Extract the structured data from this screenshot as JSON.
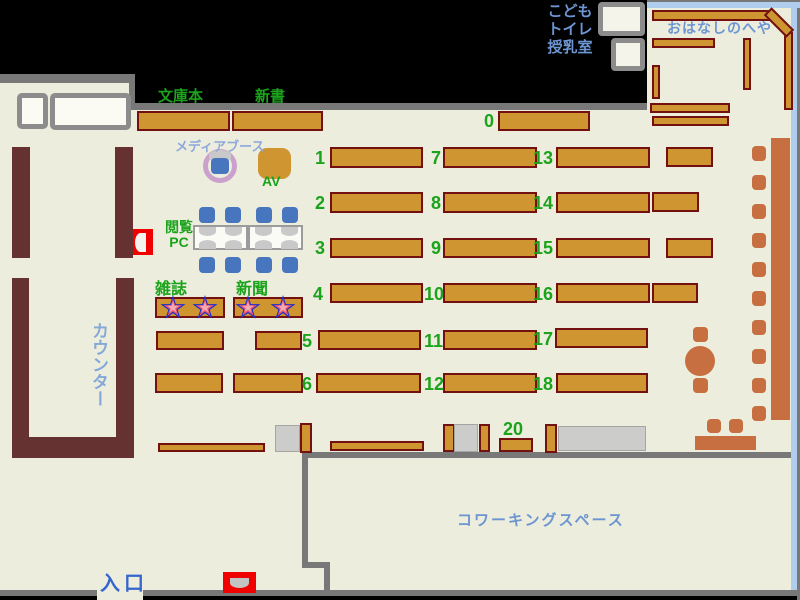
{
  "title": "library-floor-map",
  "colors": {
    "floor": "#ECEDDD",
    "wall": "#787878",
    "shelf_fill": "#CE9530",
    "shelf_border": "#731010",
    "counter": "#653231",
    "sienna": "#C76F41",
    "chair_blue": "#4876BE",
    "green": "#1CA31C",
    "label_blue": "#6C95D2",
    "counter_blue": "#84A8D8",
    "entrance_blue": "#3566CE",
    "media_blue": "#8FA8DC",
    "window_blue": "#AFCDED",
    "plum": "#CBA0CD",
    "red": "#F10000",
    "star_blue": "#1E2ECC",
    "star_red": "#E8566A",
    "star_pink": "#F6A9B2",
    "pillar": "#CCCCCB",
    "table_white": "#FBFBF6",
    "dome_gray": "#C9C9C9"
  },
  "labels": [
    {
      "id": "bunkobon",
      "text": "文庫本",
      "x": 158,
      "y": 85,
      "size": 15,
      "color": "green"
    },
    {
      "id": "shinsho",
      "text": "新書",
      "x": 255,
      "y": 85,
      "size": 15,
      "color": "green"
    },
    {
      "id": "media-booth",
      "text": "メディアブース",
      "x": 175,
      "y": 136,
      "size": 13,
      "color": "media_blue"
    },
    {
      "id": "av",
      "text": "AV",
      "x": 262,
      "y": 173,
      "size": 14,
      "color": "green"
    },
    {
      "id": "reading-pc",
      "text": "閲覧\nPC",
      "x": 160,
      "y": 220,
      "size": 14,
      "color": "green",
      "align": "center",
      "w": 38,
      "lh": 15
    },
    {
      "id": "zasshi",
      "text": "雑誌",
      "x": 155,
      "y": 275,
      "size": 16,
      "color": "green"
    },
    {
      "id": "shinbun",
      "text": "新聞",
      "x": 236,
      "y": 275,
      "size": 16,
      "color": "green"
    },
    {
      "id": "counter",
      "text": "カウンター",
      "x": 86,
      "y": 322,
      "size": 17,
      "color": "counter_blue",
      "vertical": true
    },
    {
      "id": "kids-toilet-nursing",
      "text": "こども\nトイレ\n授乳室",
      "x": 540,
      "y": 3,
      "size": 15,
      "color": "label_blue",
      "align": "center",
      "w": 60,
      "lh": 18
    },
    {
      "id": "ohanashi-room",
      "text": "おはなしのへや",
      "x": 667,
      "y": 18,
      "size": 14,
      "color": "label_blue",
      "ls": 1
    },
    {
      "id": "coworking",
      "text": "コワーキングスペース",
      "x": 457,
      "y": 509,
      "size": 15,
      "color": "label_blue",
      "ls": 2
    },
    {
      "id": "entrance",
      "text": "入口",
      "x": 100,
      "y": 567,
      "size": 20,
      "color": "entrance_blue",
      "ls": 4
    }
  ],
  "shelf_numbers": [
    {
      "text": "0",
      "x": 484,
      "y": 111
    },
    {
      "text": "1",
      "x": 315,
      "y": 148
    },
    {
      "text": "2",
      "x": 315,
      "y": 193
    },
    {
      "text": "3",
      "x": 315,
      "y": 238
    },
    {
      "text": "4",
      "x": 313,
      "y": 284
    },
    {
      "text": "5",
      "x": 302,
      "y": 331
    },
    {
      "text": "6",
      "x": 302,
      "y": 374
    },
    {
      "text": "7",
      "x": 431,
      "y": 148
    },
    {
      "text": "8",
      "x": 431,
      "y": 193
    },
    {
      "text": "9",
      "x": 431,
      "y": 238
    },
    {
      "text": "10",
      "x": 424,
      "y": 284
    },
    {
      "text": "11",
      "x": 424,
      "y": 331
    },
    {
      "text": "12",
      "x": 424,
      "y": 374
    },
    {
      "text": "13",
      "x": 533,
      "y": 148
    },
    {
      "text": "14",
      "x": 533,
      "y": 193
    },
    {
      "text": "15",
      "x": 533,
      "y": 238
    },
    {
      "text": "16",
      "x": 533,
      "y": 284
    },
    {
      "text": "17",
      "x": 533,
      "y": 329
    },
    {
      "text": "18",
      "x": 533,
      "y": 374
    },
    {
      "text": "20",
      "x": 503,
      "y": 419
    }
  ],
  "floors": [
    [
      0,
      83,
      797,
      507
    ],
    [
      647,
      2,
      144,
      81
    ],
    [
      97,
      590,
      46,
      10
    ]
  ],
  "black_patches": [
    [
      135,
      0,
      512,
      103
    ]
  ],
  "walls": [
    [
      0,
      74,
      135,
      9
    ],
    [
      129,
      74,
      6,
      36
    ],
    [
      135,
      103,
      512,
      7
    ],
    [
      303,
      452,
      497,
      6
    ],
    [
      302,
      452,
      6,
      116
    ],
    [
      302,
      562,
      28,
      6
    ],
    [
      324,
      562,
      6,
      34
    ],
    [
      0,
      590,
      97,
      6
    ],
    [
      143,
      590,
      657,
      6
    ],
    [
      647,
      0,
      153,
      2
    ],
    [
      797,
      0,
      3,
      600
    ]
  ],
  "windows": [
    [
      647,
      2,
      153,
      6
    ],
    [
      791,
      3,
      6,
      587
    ]
  ],
  "toilet_rooms": [
    [
      598,
      2,
      47,
      34
    ],
    [
      611,
      38,
      34,
      33
    ]
  ],
  "desk_boxes": [
    [
      17,
      93,
      31,
      36
    ],
    [
      50,
      93,
      81,
      37
    ]
  ],
  "counter_blocks": [
    [
      12,
      147,
      18,
      111
    ],
    [
      115,
      147,
      18,
      111
    ],
    [
      12,
      278,
      17,
      180
    ],
    [
      116,
      278,
      18,
      180
    ],
    [
      12,
      437,
      121,
      21
    ]
  ],
  "shelves_h": [
    [
      137,
      111,
      93,
      20
    ],
    [
      232,
      111,
      91,
      20
    ],
    [
      498,
      111,
      92,
      20
    ],
    [
      330,
      147,
      93,
      21
    ],
    [
      330,
      192,
      93,
      21
    ],
    [
      330,
      238,
      93,
      20
    ],
    [
      330,
      283,
      93,
      20
    ],
    [
      318,
      330,
      103,
      20
    ],
    [
      316,
      373,
      105,
      20
    ],
    [
      443,
      147,
      94,
      21
    ],
    [
      443,
      192,
      94,
      21
    ],
    [
      443,
      238,
      94,
      20
    ],
    [
      443,
      283,
      94,
      20
    ],
    [
      443,
      330,
      94,
      20
    ],
    [
      443,
      373,
      94,
      20
    ],
    [
      556,
      147,
      94,
      21
    ],
    [
      556,
      192,
      94,
      21
    ],
    [
      556,
      238,
      94,
      20
    ],
    [
      556,
      283,
      94,
      20
    ],
    [
      555,
      328,
      93,
      20
    ],
    [
      556,
      373,
      92,
      20
    ],
    [
      666,
      147,
      47,
      20
    ],
    [
      652,
      192,
      47,
      20
    ],
    [
      666,
      238,
      47,
      20
    ],
    [
      652,
      283,
      46,
      20
    ],
    [
      155,
      297,
      70,
      21
    ],
    [
      233,
      297,
      70,
      21
    ],
    [
      156,
      331,
      68,
      19
    ],
    [
      255,
      331,
      47,
      19
    ],
    [
      155,
      373,
      68,
      20
    ],
    [
      233,
      373,
      70,
      20
    ],
    [
      652,
      10,
      118,
      11
    ],
    [
      652,
      38,
      63,
      10
    ],
    [
      650,
      103,
      80,
      10
    ],
    [
      652,
      116,
      77,
      10
    ],
    [
      499,
      438,
      34,
      14
    ],
    [
      158,
      443,
      107,
      9
    ],
    [
      330,
      441,
      94,
      10
    ]
  ],
  "shelves_v": [
    [
      652,
      65,
      8,
      34
    ],
    [
      743,
      38,
      8,
      52
    ],
    [
      784,
      32,
      9,
      78
    ],
    [
      300,
      423,
      12,
      30
    ],
    [
      443,
      424,
      12,
      28
    ],
    [
      479,
      424,
      11,
      28
    ],
    [
      545,
      424,
      12,
      29
    ]
  ],
  "rotated_shelf": {
    "x": 763,
    "y": 17,
    "w": 32,
    "h": 11,
    "angle": 45
  },
  "pillars": [
    [
      275,
      425,
      25,
      27
    ],
    [
      454,
      424,
      24,
      28
    ]
  ],
  "gray_table": [
    558,
    426,
    88,
    25
  ],
  "sienna": {
    "wall_seats_x": 752,
    "wall_seats_y": [
      146,
      175,
      204,
      233,
      262,
      291,
      320,
      349,
      378,
      406
    ],
    "wall_seat_w": 14,
    "wall_seat_h": 15,
    "bench_strip": [
      771,
      138,
      19,
      282
    ],
    "round_table": [
      685,
      346,
      30,
      30
    ],
    "table_seats": [
      [
        693,
        327,
        15,
        15
      ],
      [
        693,
        378,
        15,
        15
      ]
    ],
    "bottom_bench": [
      695,
      436,
      61,
      14
    ],
    "bottom_seats": [
      [
        707,
        419,
        14,
        14
      ],
      [
        729,
        419,
        14,
        14
      ]
    ]
  },
  "pc_area": {
    "tables": [
      [
        193,
        225,
        55,
        25
      ],
      [
        248,
        225,
        55,
        25
      ]
    ],
    "domes_down": [
      [
        199,
        227
      ],
      [
        225,
        227
      ],
      [
        255,
        227
      ],
      [
        281,
        227
      ]
    ],
    "domes_up": [
      [
        199,
        240
      ],
      [
        225,
        240
      ],
      [
        255,
        240
      ],
      [
        281,
        240
      ]
    ],
    "dome_w": 17,
    "dome_h": 9,
    "chairs": [
      [
        199,
        207
      ],
      [
        225,
        207
      ],
      [
        256,
        207
      ],
      [
        282,
        207
      ],
      [
        199,
        257
      ],
      [
        225,
        257
      ],
      [
        256,
        257
      ],
      [
        282,
        257
      ]
    ],
    "chair_size": 16
  },
  "media_booth": {
    "ring": [
      203,
      149,
      34
    ],
    "dome": [
      209,
      150,
      22,
      10
    ],
    "seat": [
      211,
      158,
      18,
      16
    ],
    "av_table": [
      258,
      148,
      33,
      31
    ]
  },
  "gates": [
    {
      "x": 133,
      "y": 229,
      "w": 20,
      "h": 26,
      "dome": [
        135,
        233,
        11,
        19
      ],
      "dome_dir": "left",
      "dome_color": "#F3F3EF"
    },
    {
      "x": 223,
      "y": 572,
      "w": 33,
      "h": 21,
      "dome": [
        230,
        578,
        19,
        10
      ],
      "dome_dir": "down",
      "dome_color": "#C3C3C3"
    }
  ],
  "stars": [
    [
      173,
      308
    ],
    [
      205,
      308
    ],
    [
      248,
      308
    ],
    [
      283,
      308
    ]
  ]
}
